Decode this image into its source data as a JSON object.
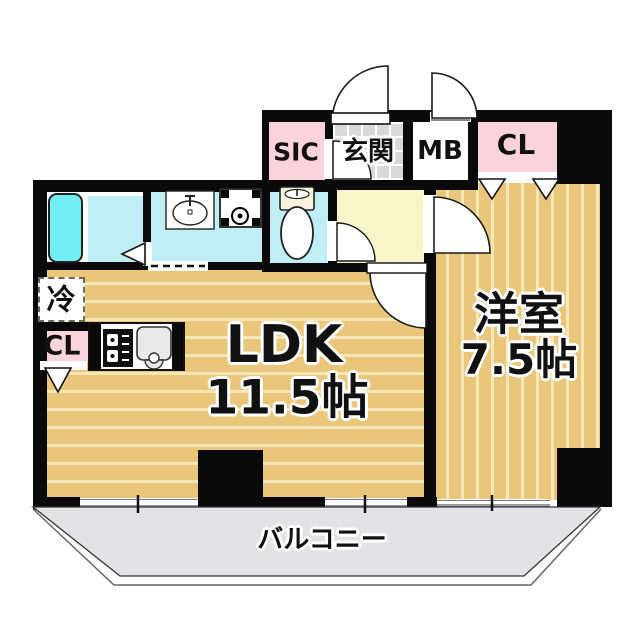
{
  "title": "apartment-floor-plan",
  "labels": {
    "sic": "SIC",
    "genkan": "玄関",
    "mb": "MB",
    "cl_top": "CL",
    "cl_left": "CL",
    "fridge": "冷",
    "ldk": "LDK",
    "ldk_size": "11.5帖",
    "western": "洋室",
    "western_size": "7.5帖",
    "balcony": "バルコニー"
  },
  "colors": {
    "wall": "#0a0a0a",
    "floor_tan": "#e9c67a",
    "floor_stripe": "#f6e7b6",
    "closet_pink": "#fad4da",
    "hall_yellow": "#faf4c9",
    "wet_cyan": "#bfeef5",
    "tub_cyan": "#71eef4",
    "tile_gray": "#d9d9d9",
    "balcony_gray": "#e3e3e6",
    "outline": "#111111"
  }
}
